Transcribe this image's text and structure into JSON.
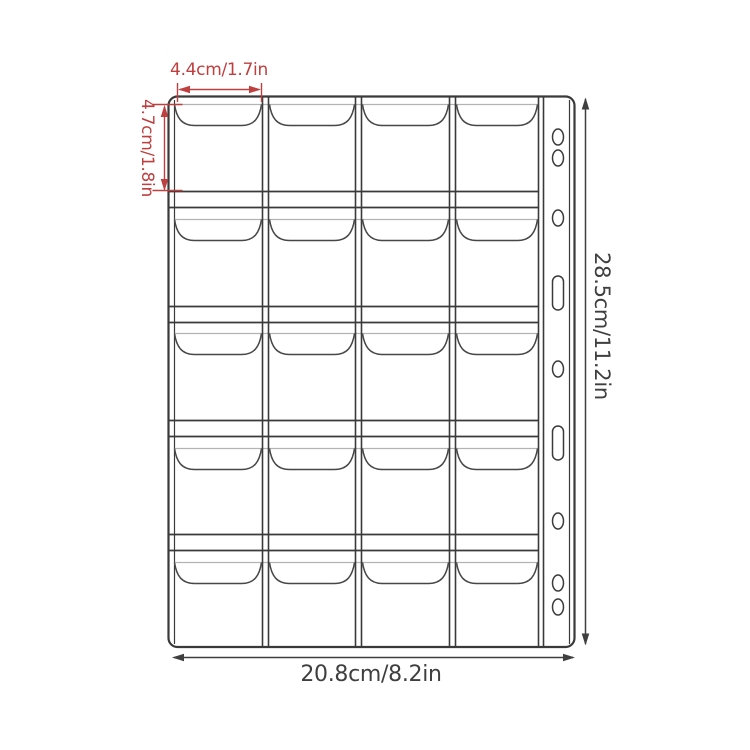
{
  "diagram": {
    "labels": {
      "pocket_width": "4.4cm/1.7in",
      "pocket_height": "4.7cm/1.8in",
      "sheet_height": "28.5cm/11.2in",
      "sheet_width": "20.8cm/8.2in"
    },
    "grid": {
      "rows": 5,
      "columns": 4,
      "pockets": 20
    },
    "binder_holes": [
      "round",
      "round",
      "round",
      "slot",
      "round",
      "slot",
      "round",
      "round",
      "round"
    ],
    "colors": {
      "outline": "#3a3a3a",
      "pocket_line": "#474747",
      "pocket_fold_line": "#b3b3b3",
      "dimension_accent": "#bf3e3e",
      "dimension_dark": "#3f3f3f",
      "background": "#ffffff"
    }
  }
}
